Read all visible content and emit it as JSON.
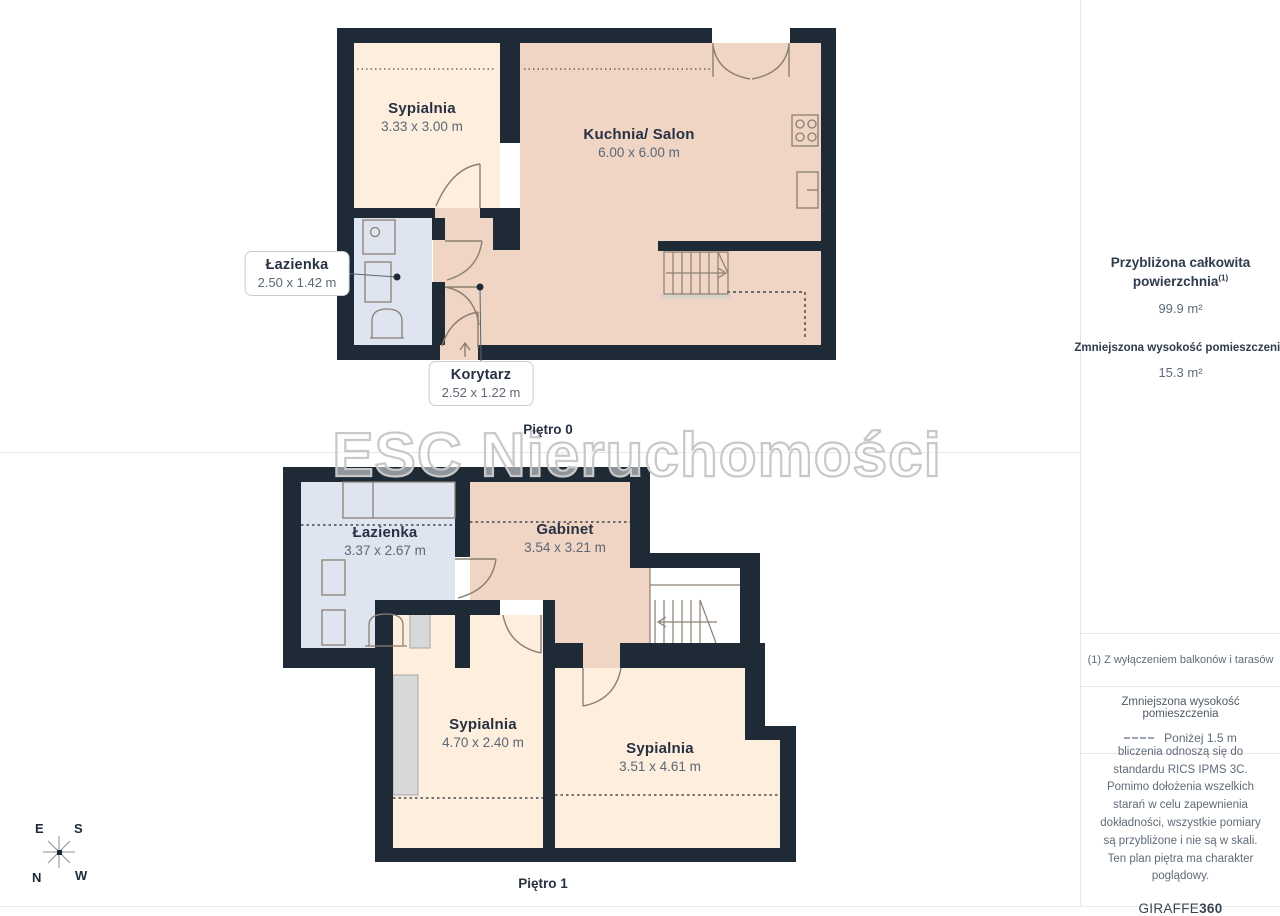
{
  "page": {
    "watermark": "ESC Nieruchomości"
  },
  "floors": [
    {
      "label": "Piętro 0",
      "rooms": [
        {
          "name": "Sypialnia",
          "dims": "3.33 x 3.00 m"
        },
        {
          "name": "Kuchnia/ Salon",
          "dims": "6.00 x 6.00 m"
        },
        {
          "name": "Łazienka",
          "dims": "2.50 x 1.42 m"
        },
        {
          "name": "Korytarz",
          "dims": "2.52 x 1.22 m"
        }
      ]
    },
    {
      "label": "Piętro 1",
      "rooms": [
        {
          "name": "Łazienka",
          "dims": "3.37 x 2.67 m"
        },
        {
          "name": "Gabinet",
          "dims": "3.54 x 3.21 m"
        },
        {
          "name": "Sypialnia",
          "dims": "4.70 x 2.40 m"
        },
        {
          "name": "Sypialnia",
          "dims": "3.51 x 4.61 m"
        }
      ]
    }
  ],
  "sidebar": {
    "total_area_title_line1": "Przybliżona całkowita",
    "total_area_title_line2": "powierzchnia",
    "total_area_footnote_marker": "(1)",
    "total_area_value": "99.9 m²",
    "reduced_height_title": "Zmniejszona wysokość pomieszczenia",
    "reduced_height_value": "15.3 m²",
    "footnote": "(1) Z wyłączeniem balkonów i tarasów",
    "legend_title": "Zmniejszona wysokość pomieszczenia",
    "legend_value": "Poniżej 1.5 m",
    "disclaimer": "bliczenia odnoszą się do standardu RICS IPMS 3C. Pomimo dołożenia wszelkich starań w celu zapewnienia dokładności, wszystkie pomiary są przybliżone i nie są w skali. Ten plan piętra ma charakter poglądowy.",
    "brand_name": "GIRAFFE",
    "brand_suffix": "360"
  },
  "compass": {
    "east": "E",
    "south": "S",
    "north": "N",
    "west": "W"
  },
  "colors": {
    "wall": "#1f2a37",
    "room_warm": "#f0d4c4",
    "room_light": "#fdeedd",
    "room_bath": "#dfe5f0",
    "fixture_stroke": "#8a7f72",
    "watermark": "#c8c8c8"
  },
  "icons": {
    "entry-arrow": "↑",
    "reduced-height-dash": "┄"
  }
}
